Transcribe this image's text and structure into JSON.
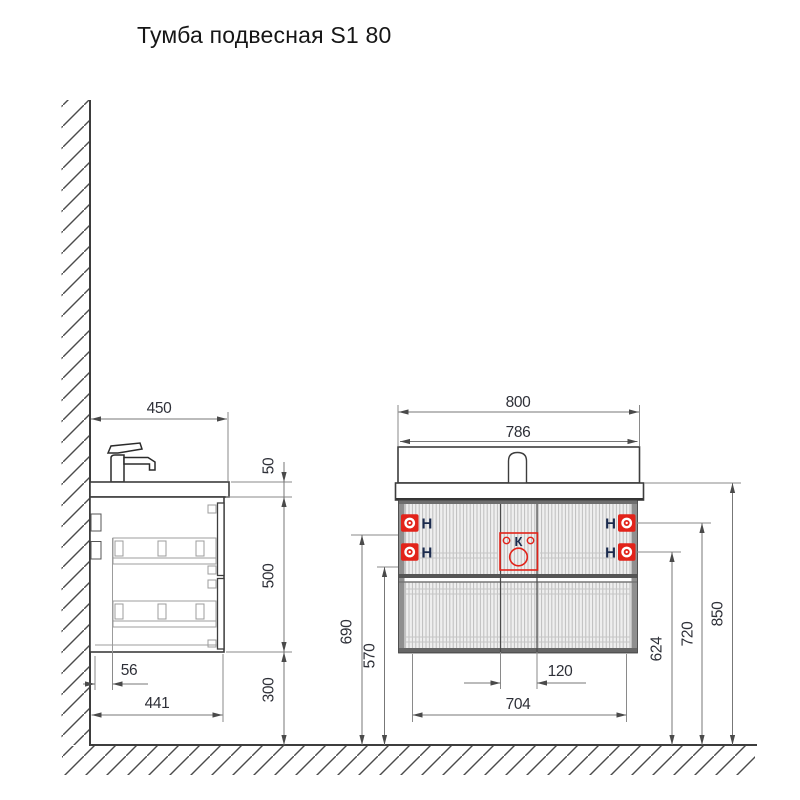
{
  "title": "Тумба подвесная S1 80",
  "side_view": {
    "dims": {
      "countertop_depth": "450",
      "countertop_thickness": "50",
      "cabinet_height": "500",
      "floor_clearance": "300",
      "wall_offset": "56",
      "total_depth": "441"
    }
  },
  "front_view": {
    "dims": {
      "overall_width": "800",
      "basin_width": "786",
      "mount_left_upper_height": "690",
      "drawer_bottom_height": "570",
      "drain_zone_width": "120",
      "mount_span": "704",
      "mount_right_lower_height": "624",
      "mount_right_upper_height": "720",
      "overall_height": "850"
    },
    "mount_label": "Н",
    "drain_label": "К"
  },
  "colors": {
    "accent_red": "#e2231a",
    "outline": "#3d3d3d",
    "dimension_line": "#777777",
    "label_text": "#2e3038",
    "marker_text": "#1b2b4e"
  }
}
